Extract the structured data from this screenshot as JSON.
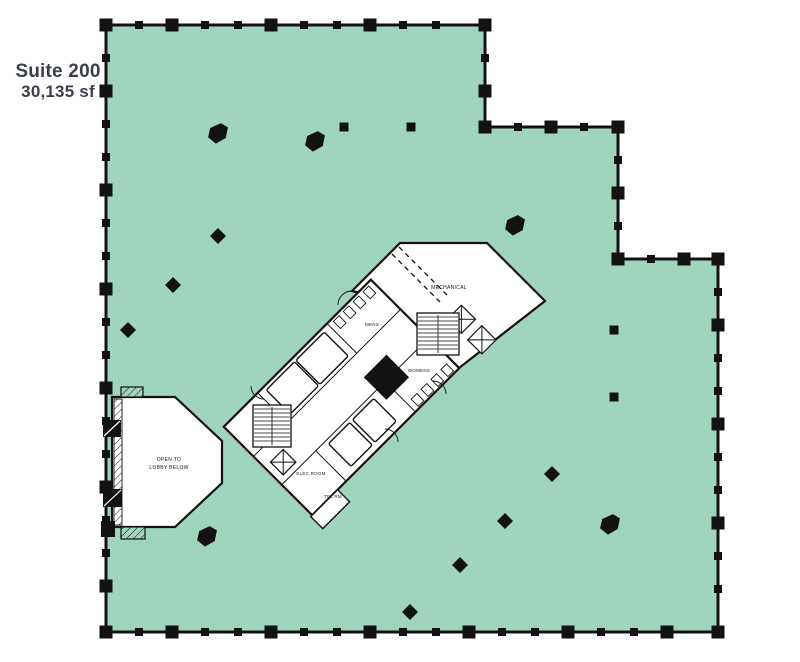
{
  "title": {
    "line1": "Suite 200",
    "line2": "30,135 sf"
  },
  "colors": {
    "suite_fill": "#9FD5BD",
    "wall": "#121212",
    "title_text": "#3A3F4B",
    "room_fill": "#FFFFFF"
  },
  "floorplan": {
    "core": {
      "labels": {
        "mechanical": "MECHANICAL",
        "mens": "MENS",
        "womens": "WOMENS",
        "elec_room": "ELEC ROOM",
        "tel_rm": "TEL RM"
      }
    },
    "lobby": {
      "line1": "OPEN TO",
      "line2": "LOBBY BELOW"
    },
    "walls": [
      {
        "x1": 106,
        "y1": 25,
        "x2": 485,
        "y2": 25
      },
      {
        "x1": 485,
        "y1": 25,
        "x2": 485,
        "y2": 127
      },
      {
        "x1": 485,
        "y1": 127,
        "x2": 618,
        "y2": 127
      },
      {
        "x1": 618,
        "y1": 127,
        "x2": 618,
        "y2": 259
      },
      {
        "x1": 618,
        "y1": 259,
        "x2": 718,
        "y2": 259
      },
      {
        "x1": 718,
        "y1": 259,
        "x2": 718,
        "y2": 632
      },
      {
        "x1": 106,
        "y1": 632,
        "x2": 718,
        "y2": 632
      },
      {
        "x1": 106,
        "y1": 25,
        "x2": 106,
        "y2": 632
      }
    ],
    "corners": [
      [
        106,
        25
      ],
      [
        485,
        25
      ],
      [
        485,
        127
      ],
      [
        618,
        127
      ],
      [
        618,
        259
      ],
      [
        718,
        259
      ],
      [
        718,
        632
      ],
      [
        106,
        632
      ]
    ],
    "columns": [
      {
        "x": 218,
        "y": 133,
        "kind": "blob"
      },
      {
        "x": 315,
        "y": 141,
        "kind": "blob"
      },
      {
        "x": 344,
        "y": 127,
        "kind": "square"
      },
      {
        "x": 411,
        "y": 127,
        "kind": "square"
      },
      {
        "x": 218,
        "y": 236,
        "kind": "diamond"
      },
      {
        "x": 173,
        "y": 285,
        "kind": "diamond"
      },
      {
        "x": 128,
        "y": 330,
        "kind": "diamond"
      },
      {
        "x": 515,
        "y": 225,
        "kind": "blob"
      },
      {
        "x": 614,
        "y": 330,
        "kind": "square"
      },
      {
        "x": 614,
        "y": 397,
        "kind": "square"
      },
      {
        "x": 552,
        "y": 474,
        "kind": "diamond"
      },
      {
        "x": 505,
        "y": 521,
        "kind": "diamond"
      },
      {
        "x": 610,
        "y": 524,
        "kind": "blob"
      },
      {
        "x": 460,
        "y": 565,
        "kind": "diamond"
      },
      {
        "x": 410,
        "y": 612,
        "kind": "diamond"
      },
      {
        "x": 207,
        "y": 536,
        "kind": "blob"
      }
    ],
    "stairs": [
      {
        "x": 253,
        "y": 405,
        "w": 38,
        "h": 42
      },
      {
        "x": 417,
        "y": 313,
        "w": 42,
        "h": 42
      }
    ]
  }
}
